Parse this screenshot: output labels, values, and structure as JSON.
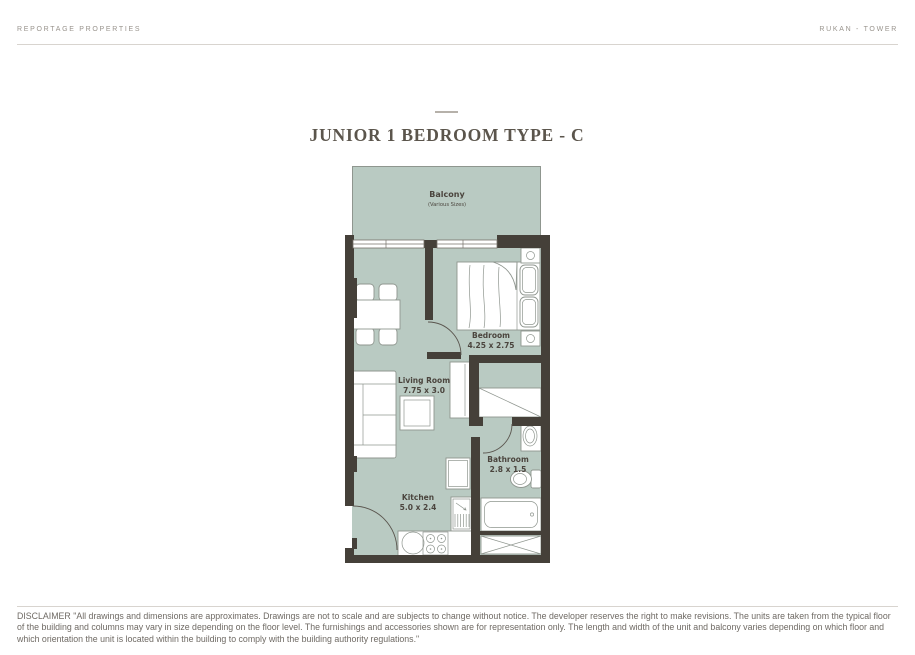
{
  "colors": {
    "floor": "#b9cac2",
    "wall": "#454039",
    "furniture_outline": "#8f968f",
    "title_text": "#5b554c",
    "muted_text": "#98938c",
    "disclaimer_text": "#6f6a64",
    "rule": "#d8d4cf",
    "label_text": "#4b453e"
  },
  "header": {
    "brand": "REPORTAGE PROPERTIES",
    "project": "RUKAN - TOWER"
  },
  "title": "JUNIOR 1 BEDROOM TYPE - C",
  "floor_plan": {
    "balcony": {
      "name": "Balcony",
      "note": "(Various Sizes)"
    },
    "bedroom": {
      "name": "Bedroom",
      "dims": "4.25 x 2.75"
    },
    "living_room": {
      "name": "Living Room",
      "dims": "7.75 x 3.0"
    },
    "bathroom": {
      "name": "Bathroom",
      "dims": "2.8 x 1.5"
    },
    "kitchen": {
      "name": "Kitchen",
      "dims": "5.0 x 2.4"
    }
  },
  "disclaimer": "DISCLAIMER \"All drawings and dimensions are approximates. Drawings are not to scale and are subjects to change without notice. The developer reserves the right to make revisions. The units are taken from the typical floor of the building and columns may vary in size depending on the floor level. The furnishings and accessories shown are for representation only. The length and width of the unit and balcony varies depending on which floor and which orientation the unit is located within the building to comply with the building authority regulations.\""
}
